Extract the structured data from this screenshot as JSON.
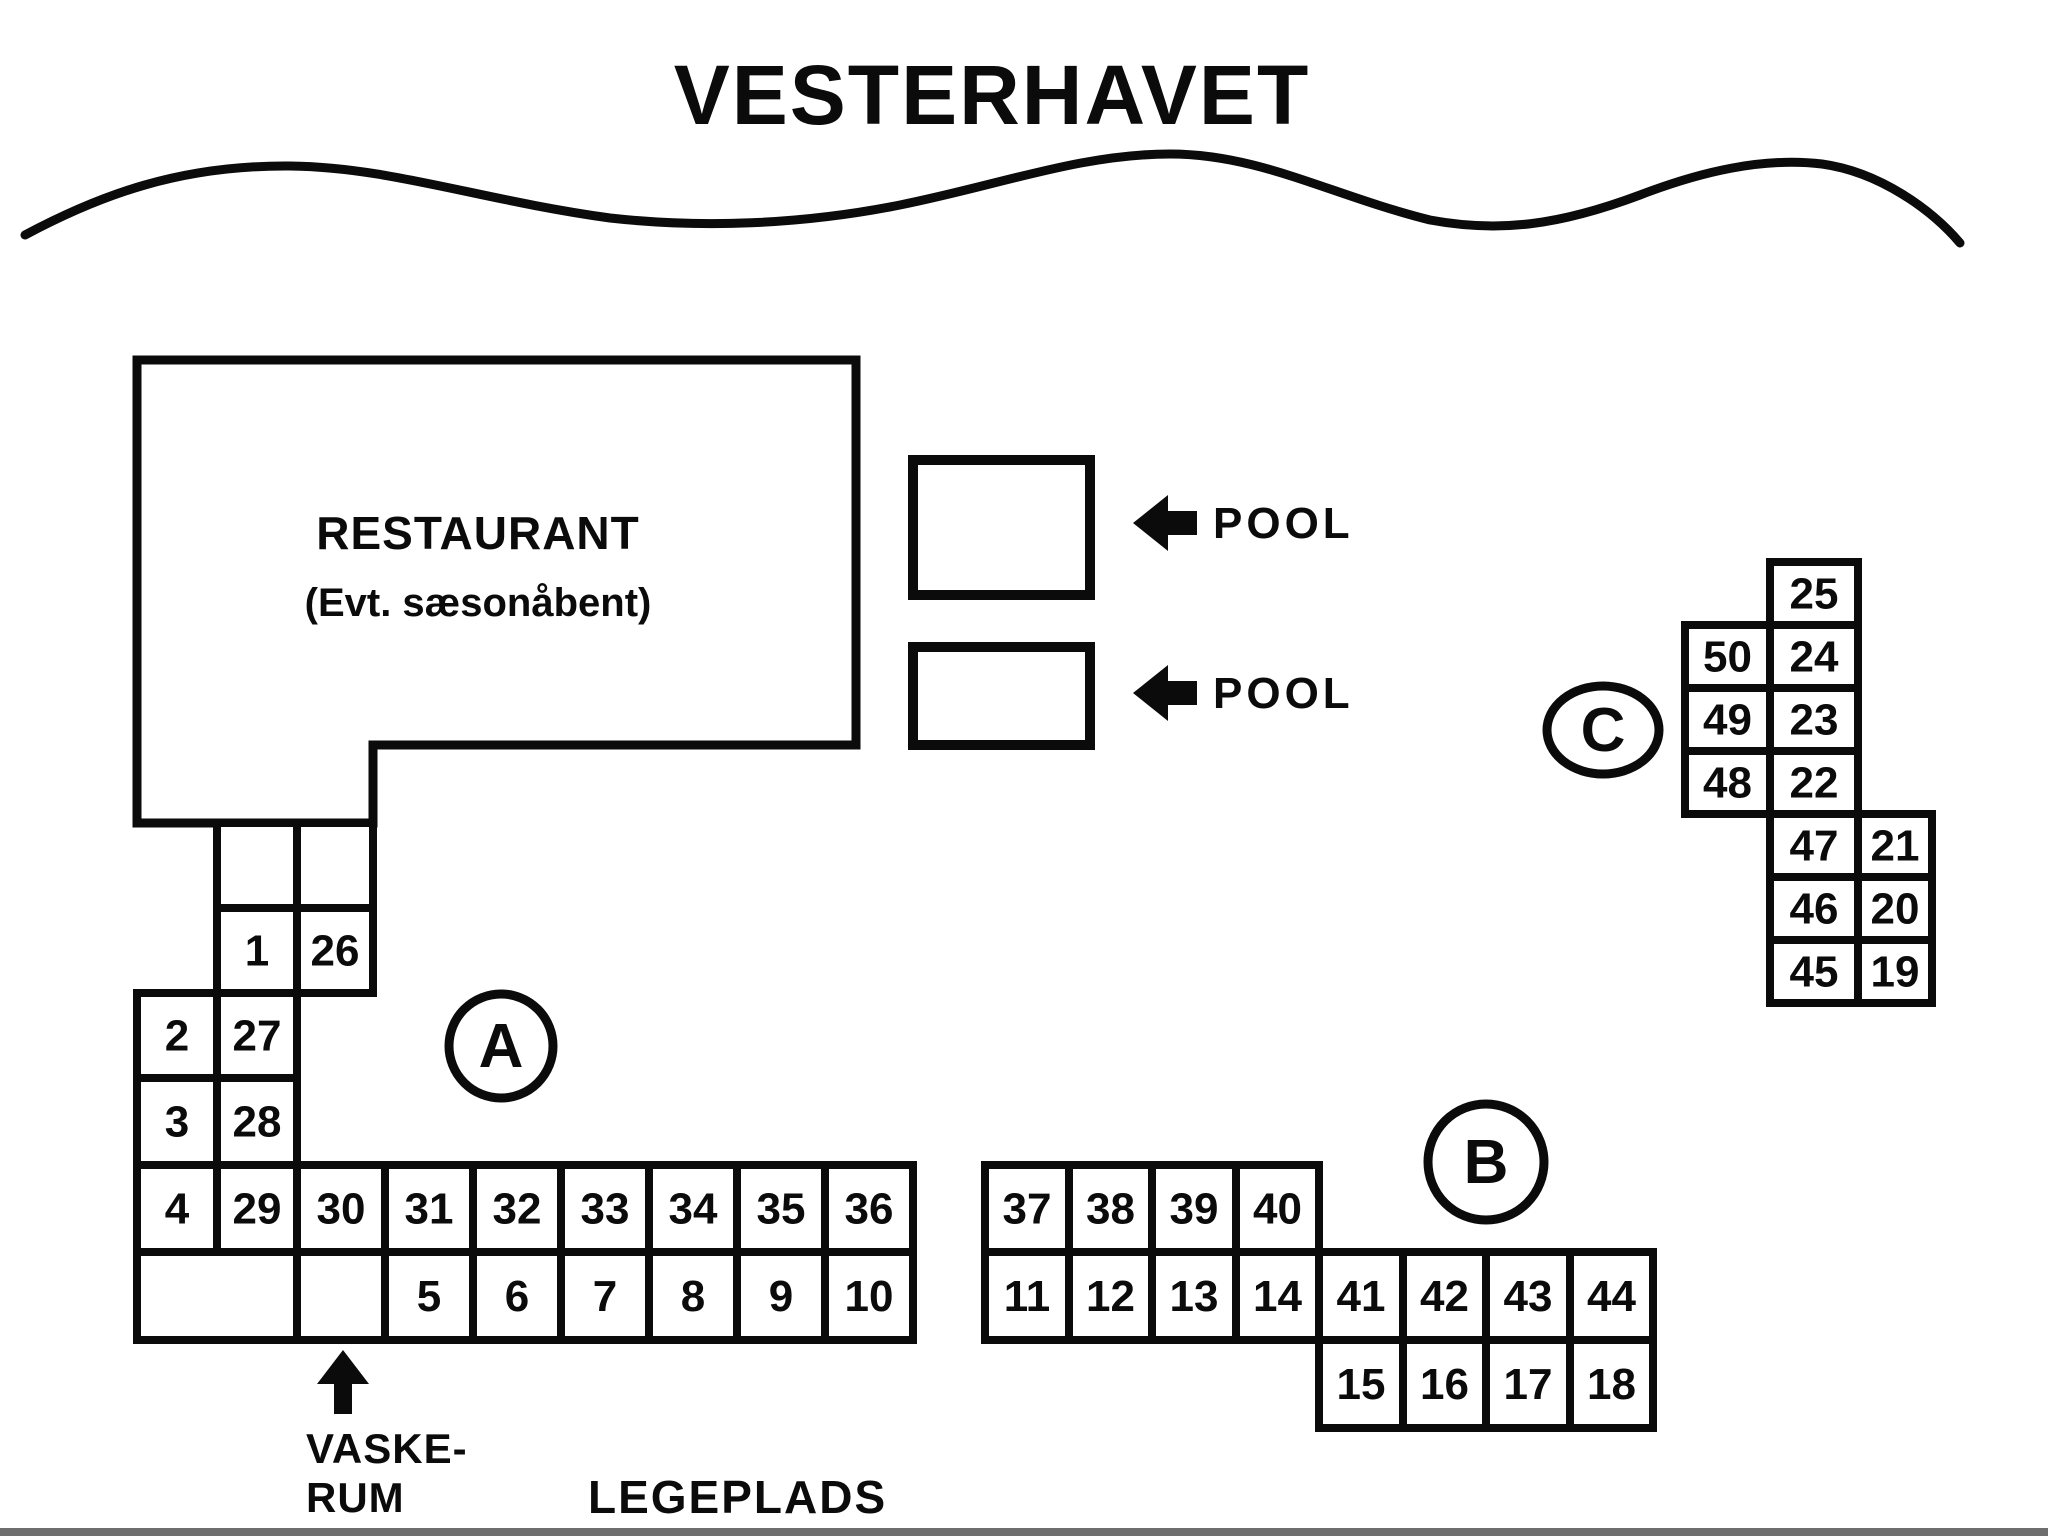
{
  "title": "VESTERHAVET",
  "restaurant": {
    "title": "RESTAURANT",
    "subtitle": "(Evt. sæsonåbent)"
  },
  "pools": [
    {
      "label": "POOL"
    },
    {
      "label": "POOL"
    }
  ],
  "laundry": {
    "line1": "VASKE-",
    "line2": "RUM"
  },
  "playground": {
    "label": "LEGEPLADS"
  },
  "colors": {
    "ink": "#0b0b0b",
    "paper": "#ffffff",
    "footer_line": "#6e6e6e"
  },
  "sections": [
    {
      "label": "A",
      "circle": {
        "cx": 501,
        "cy": 1046,
        "rx": 52,
        "ry": 52
      },
      "cells": [
        {
          "n": "",
          "x": 217,
          "y": 823,
          "w": 80,
          "h": 85
        },
        {
          "n": "",
          "x": 297,
          "y": 823,
          "w": 76,
          "h": 85
        },
        {
          "n": "1",
          "x": 217,
          "y": 908,
          "w": 80,
          "h": 85
        },
        {
          "n": "26",
          "x": 297,
          "y": 908,
          "w": 76,
          "h": 85
        },
        {
          "n": "2",
          "x": 137,
          "y": 993,
          "w": 80,
          "h": 85
        },
        {
          "n": "27",
          "x": 217,
          "y": 993,
          "w": 80,
          "h": 85
        },
        {
          "n": "3",
          "x": 137,
          "y": 1078,
          "w": 80,
          "h": 87
        },
        {
          "n": "28",
          "x": 217,
          "y": 1078,
          "w": 80,
          "h": 87
        },
        {
          "n": "4",
          "x": 137,
          "y": 1165,
          "w": 80,
          "h": 87
        },
        {
          "n": "29",
          "x": 217,
          "y": 1165,
          "w": 80,
          "h": 87
        },
        {
          "n": "30",
          "x": 297,
          "y": 1165,
          "w": 88,
          "h": 87
        },
        {
          "n": "31",
          "x": 385,
          "y": 1165,
          "w": 88,
          "h": 87
        },
        {
          "n": "32",
          "x": 473,
          "y": 1165,
          "w": 88,
          "h": 87
        },
        {
          "n": "33",
          "x": 561,
          "y": 1165,
          "w": 88,
          "h": 87
        },
        {
          "n": "34",
          "x": 649,
          "y": 1165,
          "w": 88,
          "h": 87
        },
        {
          "n": "35",
          "x": 737,
          "y": 1165,
          "w": 88,
          "h": 87
        },
        {
          "n": "36",
          "x": 825,
          "y": 1165,
          "w": 88,
          "h": 87
        },
        {
          "n": "",
          "x": 137,
          "y": 1252,
          "w": 160,
          "h": 88
        },
        {
          "n": "",
          "x": 297,
          "y": 1252,
          "w": 88,
          "h": 88
        },
        {
          "n": "5",
          "x": 385,
          "y": 1252,
          "w": 88,
          "h": 88
        },
        {
          "n": "6",
          "x": 473,
          "y": 1252,
          "w": 88,
          "h": 88
        },
        {
          "n": "7",
          "x": 561,
          "y": 1252,
          "w": 88,
          "h": 88
        },
        {
          "n": "8",
          "x": 649,
          "y": 1252,
          "w": 88,
          "h": 88
        },
        {
          "n": "9",
          "x": 737,
          "y": 1252,
          "w": 88,
          "h": 88
        },
        {
          "n": "10",
          "x": 825,
          "y": 1252,
          "w": 88,
          "h": 88
        }
      ]
    },
    {
      "label": "B",
      "circle": {
        "cx": 1486,
        "cy": 1162,
        "rx": 58,
        "ry": 58
      },
      "cells": [
        {
          "n": "37",
          "x": 985,
          "y": 1165,
          "w": 84,
          "h": 87
        },
        {
          "n": "38",
          "x": 1069,
          "y": 1165,
          "w": 83,
          "h": 87
        },
        {
          "n": "39",
          "x": 1152,
          "y": 1165,
          "w": 84,
          "h": 87
        },
        {
          "n": "40",
          "x": 1236,
          "y": 1165,
          "w": 83,
          "h": 87
        },
        {
          "n": "11",
          "x": 985,
          "y": 1252,
          "w": 84,
          "h": 88
        },
        {
          "n": "12",
          "x": 1069,
          "y": 1252,
          "w": 83,
          "h": 88
        },
        {
          "n": "13",
          "x": 1152,
          "y": 1252,
          "w": 84,
          "h": 88
        },
        {
          "n": "14",
          "x": 1236,
          "y": 1252,
          "w": 83,
          "h": 88
        },
        {
          "n": "41",
          "x": 1319,
          "y": 1252,
          "w": 84,
          "h": 88
        },
        {
          "n": "42",
          "x": 1403,
          "y": 1252,
          "w": 83,
          "h": 88
        },
        {
          "n": "43",
          "x": 1486,
          "y": 1252,
          "w": 84,
          "h": 88
        },
        {
          "n": "44",
          "x": 1570,
          "y": 1252,
          "w": 83,
          "h": 88
        },
        {
          "n": "15",
          "x": 1319,
          "y": 1340,
          "w": 84,
          "h": 88
        },
        {
          "n": "16",
          "x": 1403,
          "y": 1340,
          "w": 83,
          "h": 88
        },
        {
          "n": "17",
          "x": 1486,
          "y": 1340,
          "w": 84,
          "h": 88
        },
        {
          "n": "18",
          "x": 1570,
          "y": 1340,
          "w": 83,
          "h": 88
        }
      ]
    },
    {
      "label": "C",
      "circle": {
        "cx": 1603,
        "cy": 730,
        "rx": 56,
        "ry": 44
      },
      "cells": [
        {
          "n": "25",
          "x": 1770,
          "y": 562,
          "w": 88,
          "h": 63
        },
        {
          "n": "50",
          "x": 1685,
          "y": 625,
          "w": 85,
          "h": 63
        },
        {
          "n": "24",
          "x": 1770,
          "y": 625,
          "w": 88,
          "h": 63
        },
        {
          "n": "49",
          "x": 1685,
          "y": 688,
          "w": 85,
          "h": 63
        },
        {
          "n": "23",
          "x": 1770,
          "y": 688,
          "w": 88,
          "h": 63
        },
        {
          "n": "48",
          "x": 1685,
          "y": 751,
          "w": 85,
          "h": 63
        },
        {
          "n": "22",
          "x": 1770,
          "y": 751,
          "w": 88,
          "h": 63
        },
        {
          "n": "47",
          "x": 1770,
          "y": 814,
          "w": 88,
          "h": 63
        },
        {
          "n": "21",
          "x": 1858,
          "y": 814,
          "w": 74,
          "h": 63
        },
        {
          "n": "46",
          "x": 1770,
          "y": 877,
          "w": 88,
          "h": 63
        },
        {
          "n": "20",
          "x": 1858,
          "y": 877,
          "w": 74,
          "h": 63
        },
        {
          "n": "45",
          "x": 1770,
          "y": 940,
          "w": 88,
          "h": 63
        },
        {
          "n": "19",
          "x": 1858,
          "y": 940,
          "w": 74,
          "h": 63
        }
      ]
    }
  ]
}
